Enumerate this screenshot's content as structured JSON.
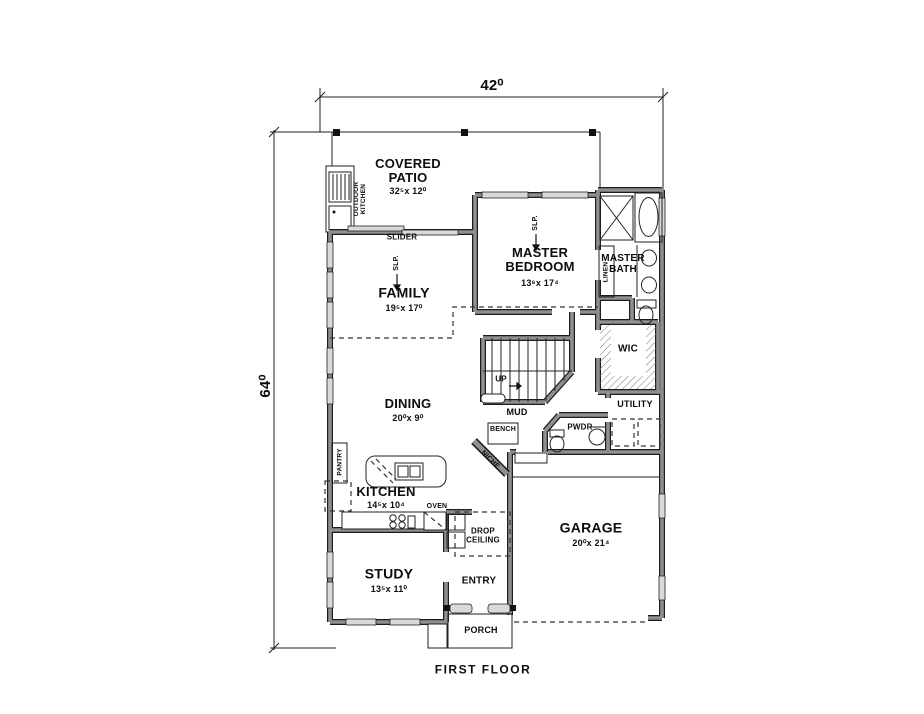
{
  "sheet": {
    "title": "FIRST FLOOR"
  },
  "dimensions": {
    "width": "42⁰",
    "depth": "64⁰"
  },
  "rooms": {
    "covered_patio": {
      "name": "COVERED\nPATIO",
      "dims": "32⁵x 12⁰"
    },
    "master_bedroom": {
      "name": "MASTER\nBEDROOM",
      "dims": "13⁶x 17⁴"
    },
    "master_bath": {
      "name": "MASTER\nBATH"
    },
    "family": {
      "name": "FAMILY",
      "dims": "19⁵x 17⁰"
    },
    "dining": {
      "name": "DINING",
      "dims": "20⁰x 9⁰"
    },
    "kitchen": {
      "name": "KITCHEN",
      "dims": "14⁵x 10⁴"
    },
    "study": {
      "name": "STUDY",
      "dims": "13⁵x 11⁰"
    },
    "garage": {
      "name": "GARAGE",
      "dims": "20⁰x 21⁴"
    },
    "entry": {
      "name": "ENTRY"
    },
    "porch": {
      "name": "PORCH"
    },
    "mud": {
      "name": "MUD"
    },
    "pwdr": {
      "name": "PWDR"
    },
    "utility": {
      "name": "UTILITY"
    },
    "wic": {
      "name": "WIC"
    }
  },
  "labels": {
    "slider": "SLIDER",
    "outdoor_kitchen": "OUTDOOR\nKITCHEN",
    "linen": "LINEN",
    "pantry": "PANTRY",
    "bench": "BENCH",
    "niche": "NICHE",
    "oven": "OVEN",
    "drop_ceiling": "DROP\nCEILING",
    "up": "UP",
    "slp_family": "SLP.",
    "slp_master": "SLP."
  },
  "colors": {
    "line": "#1c1c1c",
    "wall_fill": "#8f8f8f",
    "window_fill": "#d9d9d9",
    "background": "#ffffff"
  }
}
